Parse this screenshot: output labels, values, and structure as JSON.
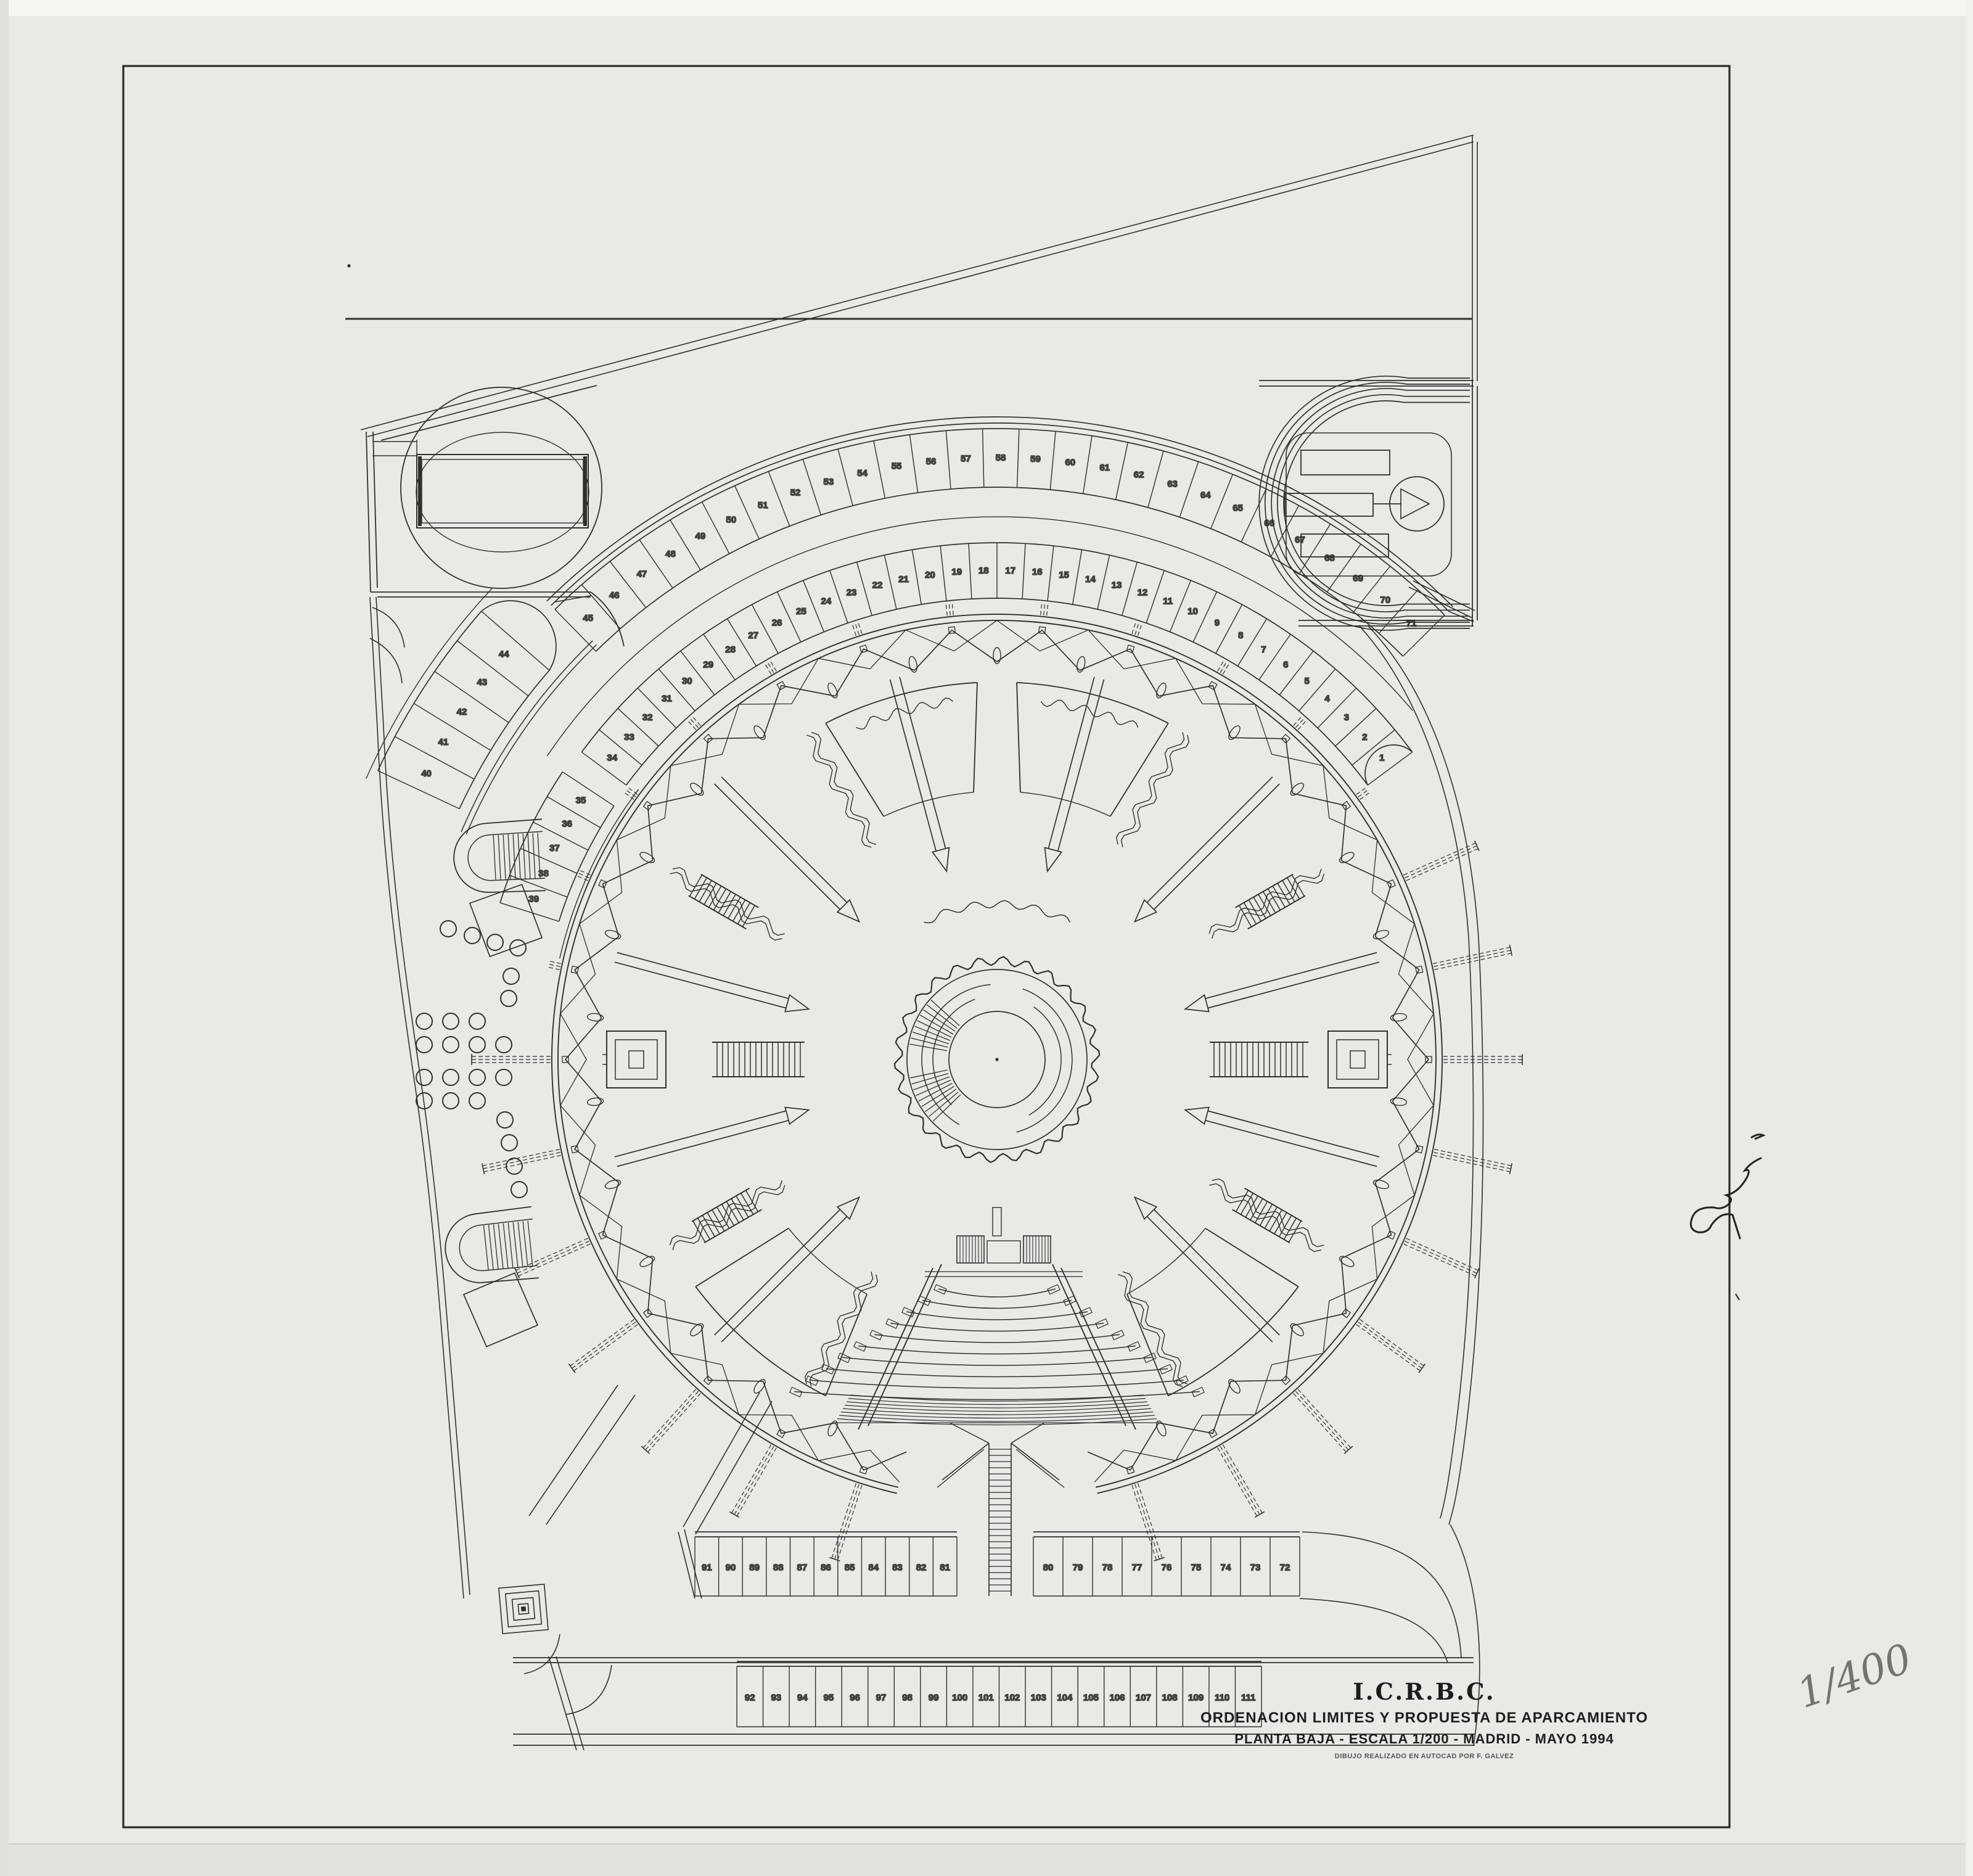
{
  "palette": {
    "paper": "#e9e9e6",
    "paper_top_strip": "#f5f5f2",
    "paper_bottom_band": "#e2e2df",
    "ink": "#2f2f2c",
    "pencil": "#73736f"
  },
  "title_block": {
    "organization": "I.C.R.B.C.",
    "line1": "ORDENACION LIMITES Y PROPUESTA DE APARCAMIENTO",
    "line2": "PLANTA BAJA - ESCALA 1/200 - MADRID - MAYO 1994",
    "credit": "DIBUJO REALIZADO EN AUTOCAD POR F. GALVEZ"
  },
  "annotations": {
    "handwritten_scale": "1/400"
  },
  "parking": {
    "total_spaces": 111,
    "outer_arc_numbers_left_to_right": [
      45,
      46,
      47,
      48,
      49,
      50,
      51,
      52,
      53,
      54,
      55,
      56,
      57,
      58,
      59,
      60,
      61,
      62,
      63,
      64,
      65,
      66,
      67,
      68,
      69,
      70,
      71
    ],
    "inner_arc_numbers_left_to_right": [
      34,
      33,
      32,
      31,
      30,
      29,
      28,
      27,
      26,
      25,
      24,
      23,
      22,
      21,
      20,
      19,
      18,
      17,
      16,
      15,
      14,
      13,
      12,
      11,
      10,
      9,
      8,
      7,
      6,
      5,
      4,
      3,
      2,
      1
    ],
    "bank_upper_left_numbers_top_to_bottom": [
      44,
      43,
      42,
      41,
      40
    ],
    "bank_lower_left_numbers_top_to_bottom": [
      35,
      36,
      37,
      38,
      39
    ],
    "bottom_upper_row_left_numbers": [
      91,
      90,
      89,
      88,
      87,
      86,
      85,
      84,
      83,
      82,
      81
    ],
    "bottom_upper_row_right_numbers": [
      80,
      79,
      78,
      77,
      76,
      75,
      74,
      73,
      72
    ],
    "bottom_lower_row_numbers": [
      92,
      93,
      94,
      95,
      96,
      97,
      98,
      99,
      100,
      101,
      102,
      103,
      104,
      105,
      106,
      107,
      108,
      109,
      110,
      111
    ]
  }
}
